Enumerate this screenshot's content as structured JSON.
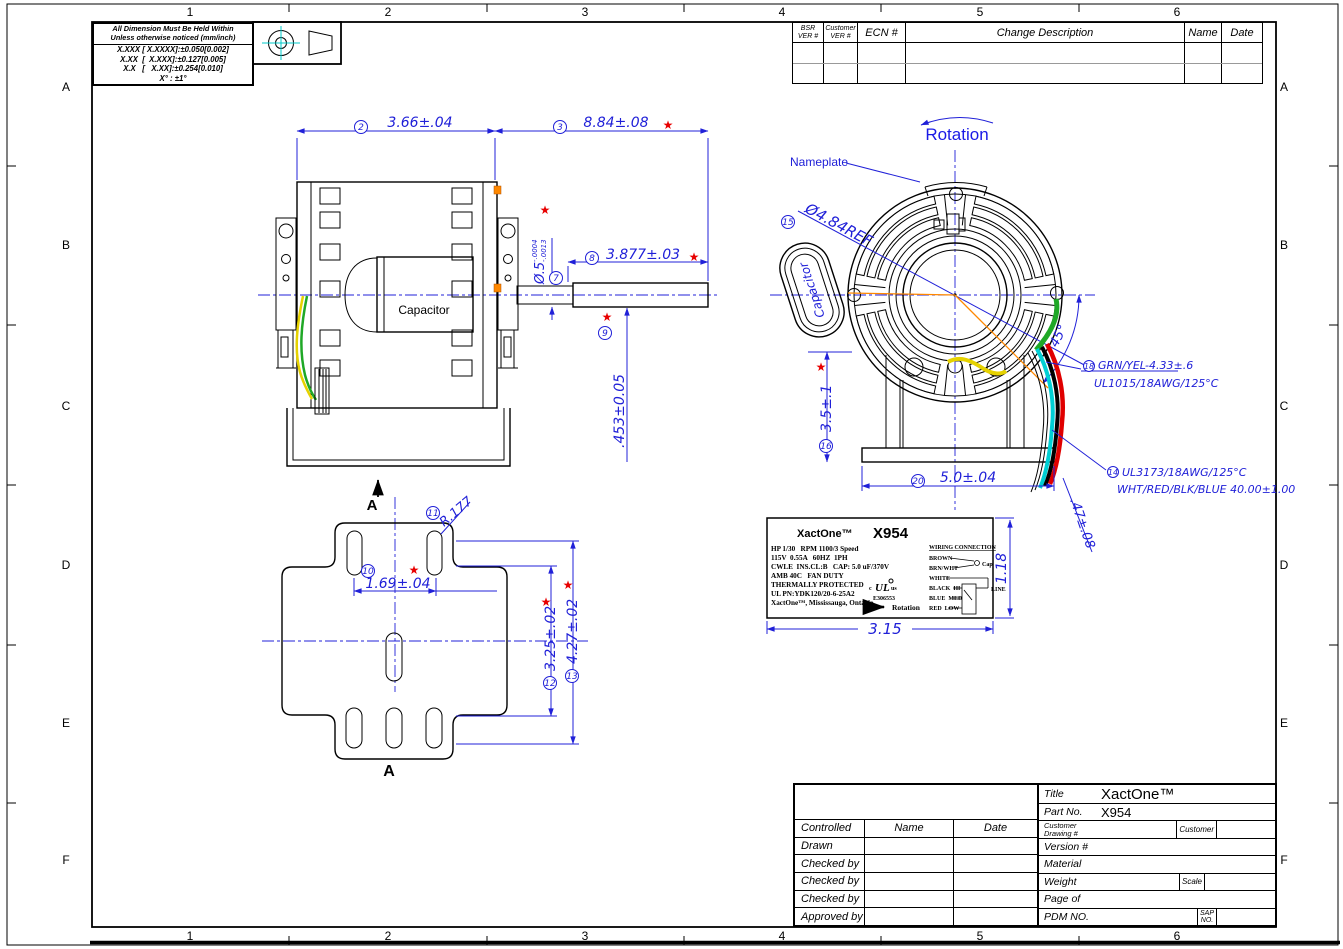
{
  "symbols": {
    "star": "★"
  },
  "colors": {
    "dimension_blue": "#2020d8",
    "critical_red": "#e80000",
    "wire_green": "#1fa826",
    "wire_yellow": "#e6d200",
    "wire_cyan": "#00cfd4",
    "wire_red": "#e00000",
    "wire_black": "#000000",
    "leader_orange": "#ff8800",
    "centerline_cyan": "#00c8c8"
  },
  "border": {
    "cols": [
      "1",
      "2",
      "3",
      "4",
      "5",
      "6"
    ],
    "rows": [
      "A",
      "B",
      "C",
      "D",
      "E",
      "F"
    ]
  },
  "tolerance_block": {
    "line1": "All Dimension Must Be Held Within",
    "line2": "Unless otherwise noticed (mm/inch)",
    "row1": "X.XXX [ X.XXXX]:±0.050[0.002]",
    "row2": "X.XX  [  X.XXX]:±0.127[0.005]",
    "row3": "X.X   [   X.XX]:±0.254[0.010]",
    "row4": "X° : ±1°"
  },
  "revision_table": {
    "h_bsr1": "BSR",
    "h_bsr2": "VER #",
    "h_cust1": "Customer",
    "h_cust2": "VER #",
    "h_ecn": "ECN #",
    "h_desc": "Change Description",
    "h_name": "Name",
    "h_date": "Date"
  },
  "side_view": {
    "capacitor_label": "Capacitor",
    "section_arrow_label": "A",
    "dim_width": {
      "balloon": "2",
      "text": "3.66±.04"
    },
    "dim_length": {
      "balloon": "3",
      "text": "8.84±.08"
    },
    "dim_shaft_dia": {
      "balloon": "7",
      "text": "Ø.5",
      "tol_top": "-.0004",
      "tol_bot": "-.0013"
    },
    "dim_shaft_len": {
      "balloon": "8",
      "text": "3.877±.03"
    },
    "dim_flat": {
      "balloon": "9",
      "text": ".453±0.05"
    }
  },
  "front_view": {
    "rotation_label": "Rotation",
    "nameplate_callout": "Nameplate",
    "capacitor_label": "Capacitor",
    "dim_bolt_circle": {
      "balloon": "15",
      "text": "Ø4.84REF"
    },
    "dim_height": {
      "balloon": "16",
      "text": "3.5±.1"
    },
    "dim_base": {
      "balloon": "20",
      "text": "5.0±.04"
    },
    "dim_angle": {
      "text": "45°"
    },
    "dim_lead": {
      "text": ".47±.08"
    },
    "wire_ground": {
      "balloon": "18",
      "line1": "GRN/YEL-4.33±.6",
      "line2": "UL1015/18AWG/125°C"
    },
    "wire_leads": {
      "balloon": "14",
      "line1": "UL3173/18AWG/125°C",
      "line2": "WHT/RED/BLK/BLUE 40.00±1.00"
    }
  },
  "bracket_view": {
    "section_label_top": "A",
    "section_label_bottom": "A",
    "dim_slot_spacing": {
      "balloon": "10",
      "text": "1.69±.04"
    },
    "dim_radius": {
      "balloon": "11",
      "text": "R.177"
    },
    "dim_inner": {
      "balloon": "12",
      "text": "3.25±.02"
    },
    "dim_outer": {
      "balloon": "13",
      "text": "4.27±.02"
    }
  },
  "nameplate": {
    "brand": "XactOne™",
    "model": "X954",
    "spec1": "HP 1/30   RPM 1100/3 Speed",
    "spec2": "115V  0.55A   60HZ  1PH",
    "spec3": "CWLE  INS.CL:B   CAP: 5.0 uF/370V",
    "spec4": "AMB 40C   FAN DUTY",
    "spec5": "THERMALLY PROTECTED",
    "spec6": "UL PN:YDK120/20-6-25A2",
    "spec7": "XactOne™, Mississauga, Ontario",
    "ul_prefix": "c",
    "ul_mark": "UL",
    "ul_suffix": "us",
    "ul_number": "E306553",
    "rotation_label": "Rotation",
    "wiring_title": "WIRING CONNECTION",
    "wire1": "BROWN",
    "wire2": "BRN/WHT",
    "wire3": "WHITE",
    "wire4": "BLACK  HI",
    "wire5": "BLUE  MED",
    "wire6": "RED  LOW",
    "cap_label": "Cap",
    "line_label": "LINE",
    "dim_width": "3.15",
    "dim_height": "1.18"
  },
  "title_block": {
    "title_label": "Title",
    "title_value": "XactOne™",
    "part_label": "Part No.",
    "part_value": "X954",
    "controlled": "Controlled",
    "name": "Name",
    "date": "Date",
    "drawn": "Drawn",
    "checked1": "Checked by",
    "checked2": "Checked by",
    "checked3": "Checked by",
    "approved": "Approved by",
    "customer_drawing_l1": "Customer",
    "customer_drawing_l2": "Drawing #",
    "customer": "Customer",
    "version": "Version #",
    "material": "Material",
    "weight": "Weight",
    "scale": "Scale",
    "page": "Page of",
    "pdm": "PDM NO.",
    "sap_l1": "SAP",
    "sap_l2": "NO."
  }
}
